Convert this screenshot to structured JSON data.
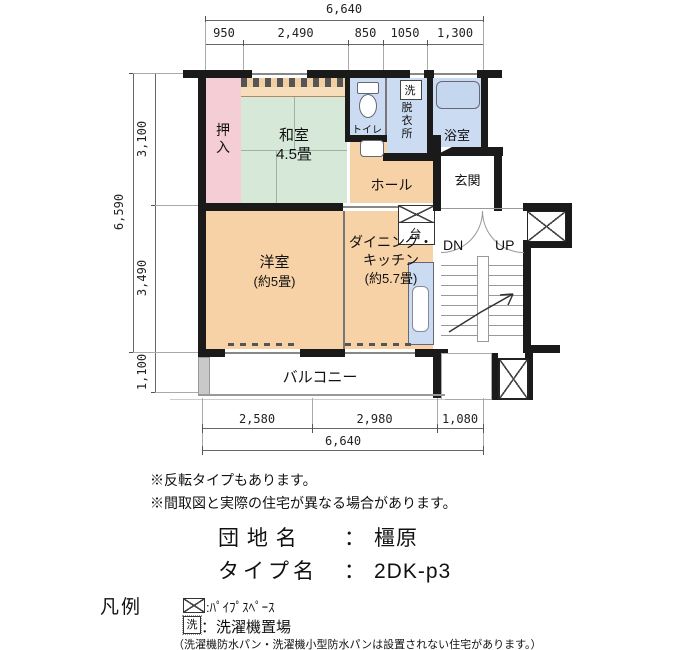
{
  "plan": {
    "rooms": {
      "oshiire": "押入",
      "washitsu": "和室",
      "washitsu_size": "4.5畳",
      "toilet": "トイレ",
      "washer_mark": "洗",
      "datsuiijo": "脱衣所",
      "bathroom": "浴室",
      "hall": "ホール",
      "genkan": "玄関",
      "counter": "台",
      "yoshitsu": "洋室",
      "yoshitsu_size": "(約5畳)",
      "dk1": "ダイニング・",
      "dk2": "キッチン",
      "dk3": "(約5.7畳)",
      "balcony": "バルコニー",
      "dn": "DN",
      "up": "UP"
    },
    "dimensions": {
      "top_total": "6,640",
      "top_segments": [
        "950",
        "2,490",
        "850",
        "1050",
        "1,300"
      ],
      "left_total": "6,590",
      "left_upper": "3,100",
      "left_lower": "3,490",
      "left_balcony": "1,100",
      "bottom_segments": [
        "2,580",
        "2,980",
        "1,080"
      ],
      "bottom_total": "6,640"
    }
  },
  "notes": [
    "※反転タイプもあります。",
    "※間取図と実際の住宅が異なる場合があります。"
  ],
  "estate": {
    "name_label": "団 地 名",
    "name_sep": "：",
    "name_value": "橿原",
    "type_label": "タイプ名",
    "type_sep": "：",
    "type_value": "2DK-p3"
  },
  "legend": {
    "title": "凡例",
    "pipe_text": ":ﾊﾟｲﾌﾟｽﾍﾟｰｽ",
    "washer_mark": "洗",
    "washer_text": "：洗濯機置場",
    "note": "（洗濯機防水パン・洗濯機小型防水パンは設置されない住宅があります。）"
  },
  "colors": {
    "wall": "#1a1a1a",
    "room_tatami": "#d6e9d8",
    "room_western": "#f7d2a6",
    "room_wet": "#cbdcf2",
    "room_closet": "#f5cdd4"
  }
}
